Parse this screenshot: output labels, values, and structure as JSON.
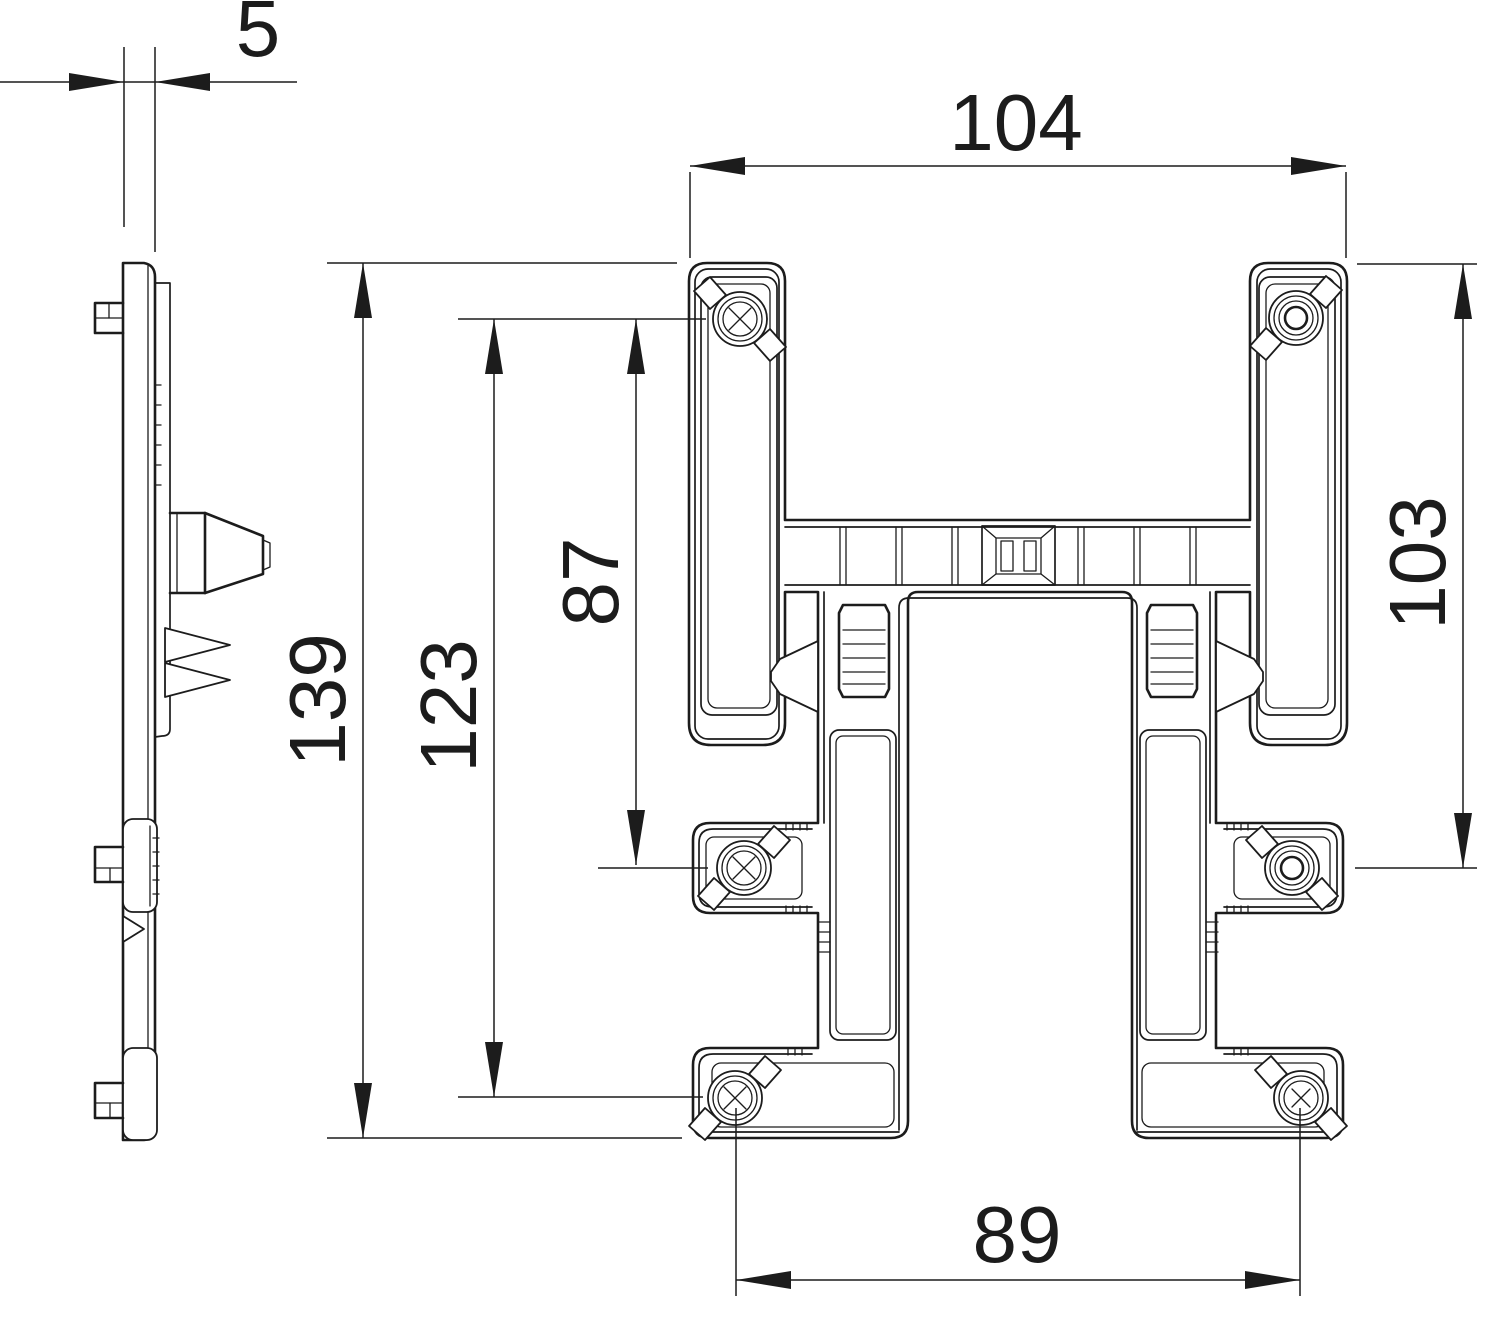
{
  "drawing": {
    "kind": "technical-dimension-drawing",
    "views": {
      "left": "side-profile-view",
      "right": "front-view-mounting-bracket"
    },
    "colors": {
      "line": "#1c1c1c",
      "background": "#ffffff"
    },
    "dimensions": {
      "side_thickness": "5",
      "top_width": "104",
      "overall_height": "139",
      "outer_screw_spacing": "123",
      "upper_screw_spacing": "87",
      "right_height": "103",
      "bottom_width": "89"
    }
  }
}
